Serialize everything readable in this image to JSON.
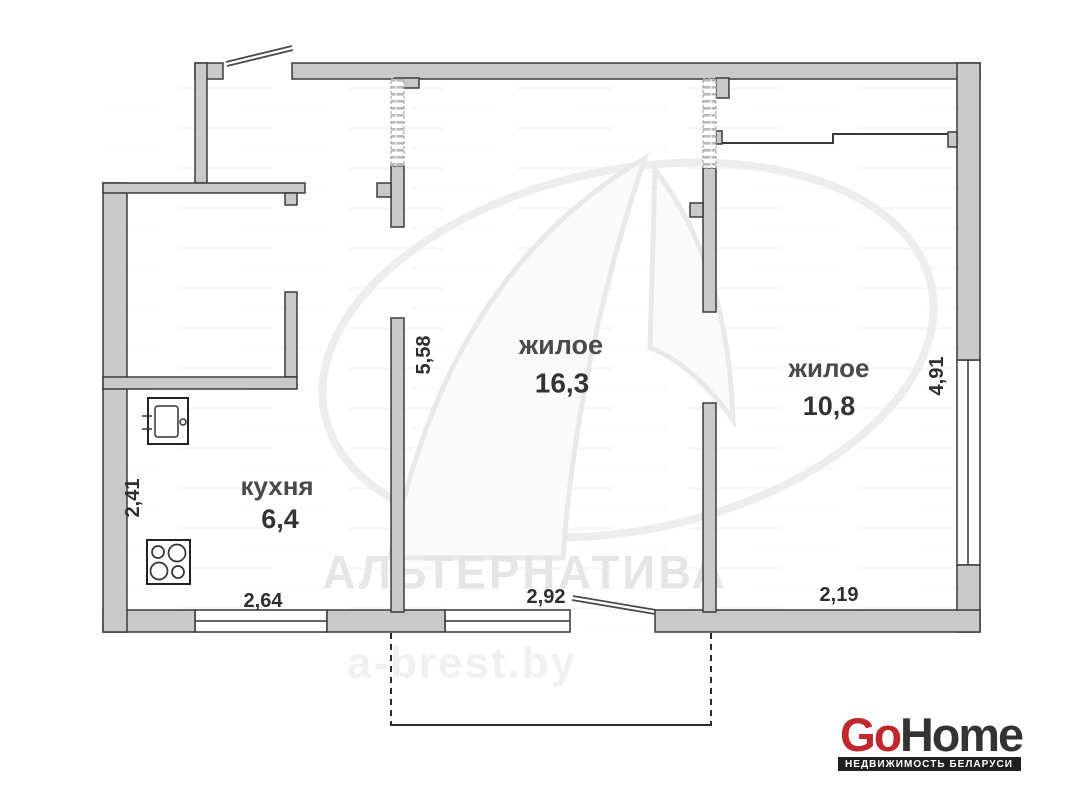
{
  "rooms": {
    "living_main": {
      "name": "жилое",
      "area": "16,3"
    },
    "living_second": {
      "name": "жилое",
      "area": "10,8"
    },
    "kitchen": {
      "name": "кухня",
      "area": "6,4"
    }
  },
  "dimensions": {
    "living_main_depth": "5,58",
    "living_second_depth": "4,91",
    "kitchen_depth": "2,41",
    "kitchen_window_width": "2,64",
    "balcony_exit_width": "2,92",
    "living_second_width": "2,19"
  },
  "watermark": {
    "agency": "АЛЬТЕРНАТИВА",
    "website": "a-brest.by"
  },
  "logo": {
    "brand_red": "Go",
    "brand_dark": "Home",
    "tagline": "НЕДВИЖИМОСТЬ БЕЛАРУСИ",
    "accent_color": "#c1272d",
    "bar_color": "#1f1f1f"
  }
}
